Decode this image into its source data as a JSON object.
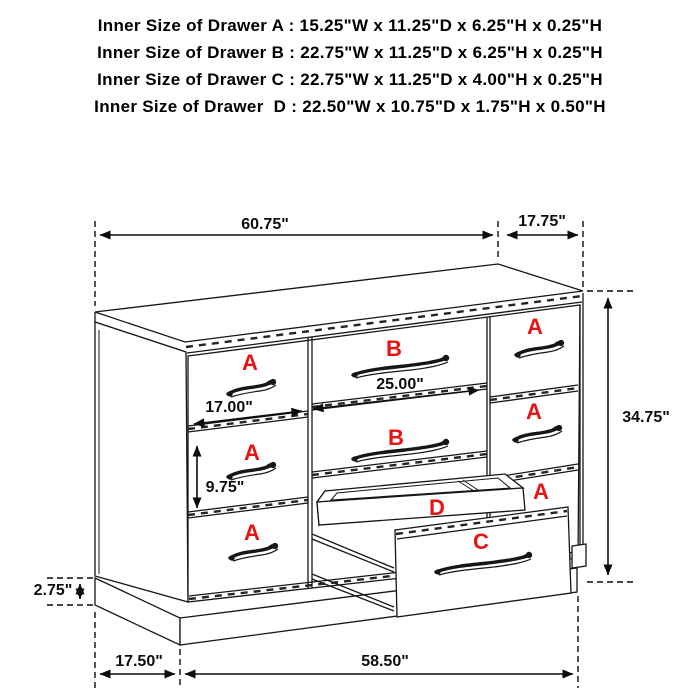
{
  "header": {
    "lines": [
      "Inner Size of Drawer A : 15.25\"W x 11.25\"D x 6.25\"H x 0.25\"H",
      "Inner Size of Drawer B : 22.75\"W x 11.25\"D x 6.25\"H x 0.25\"H",
      "Inner Size of Drawer C : 22.75\"W x 11.25\"D x 4.00\"H x 0.25\"H",
      "Inner Size of Drawer  D : 22.50\"W x 10.75\"D x 1.75\"H x 0.50\"H"
    ]
  },
  "diagram": {
    "dimensions": {
      "top_width": "60.75\"",
      "top_depth": "17.75\"",
      "height": "34.75\"",
      "drawer_a_width": "17.00\"",
      "drawer_b_width": "25.00\"",
      "drawer_a_height": "9.75\"",
      "base_height": "2.75\"",
      "bottom_depth": "17.50\"",
      "bottom_width": "58.50\""
    },
    "drawer_labels": {
      "a": "A",
      "b": "B",
      "c": "C",
      "d": "D"
    },
    "colors": {
      "label_red": "#e81313",
      "line_black": "#161616"
    }
  }
}
